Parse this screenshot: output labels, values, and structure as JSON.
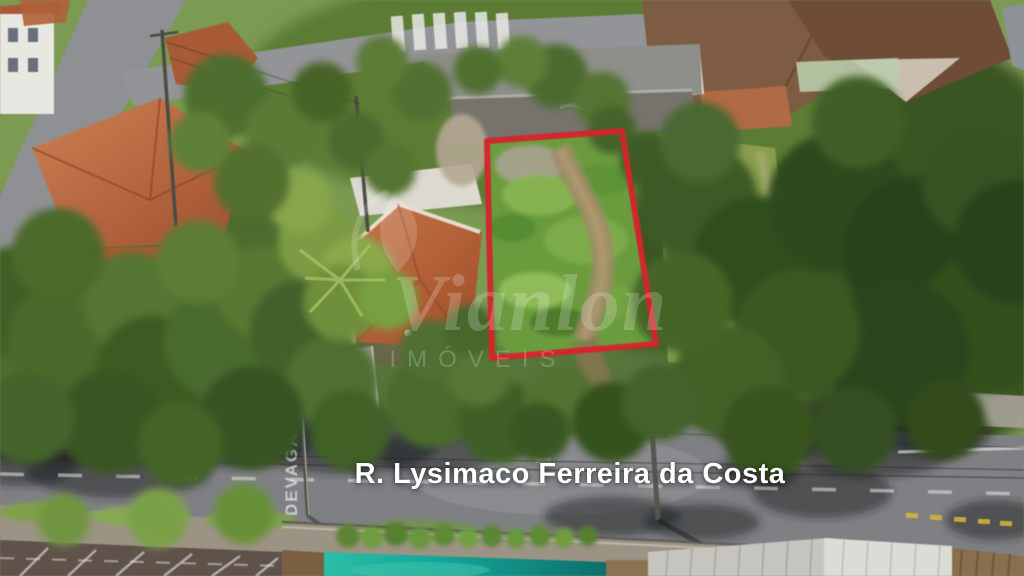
{
  "overlays": {
    "street_label": "R. Lysimaco Ferreira da Costa",
    "watermark": {
      "name": "Vianlon",
      "subtitle": "IMÓVEIS"
    },
    "road_paint_text": "DEVAGAR"
  },
  "colors": {
    "boundary_red": "#d6242b",
    "pool_teal": "#14a296",
    "lot_grass_green": "#6a9c3e",
    "road_gray": "#7f8084",
    "roof_terracotta": "#b5603c",
    "street_label_white": "#ffffff"
  }
}
